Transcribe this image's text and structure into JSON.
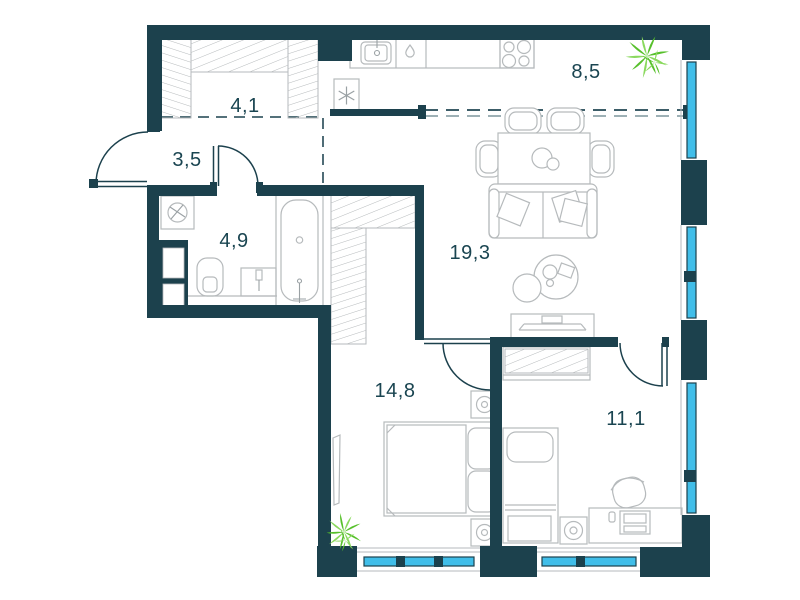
{
  "plan_title": "apartment-floor-plan",
  "rooms": [
    {
      "name": "wardrobe",
      "area": "4,1"
    },
    {
      "name": "hallway",
      "area": "3,5"
    },
    {
      "name": "bathroom",
      "area": "4,9"
    },
    {
      "name": "living-room",
      "area": "19,3"
    },
    {
      "name": "kitchen-zone",
      "area": "8,5"
    },
    {
      "name": "bedroom-1",
      "area": "14,8"
    },
    {
      "name": "bedroom-2",
      "area": "11,1"
    }
  ],
  "colors": {
    "wall": "#1c414d",
    "window_glass": "#41bee9",
    "furniture_line": "#b6babc",
    "furniture_line_dark": "#9aa1a4",
    "plant_primary": "#57c02b",
    "plant_secondary": "#8ad95e",
    "label_text": "#1a4551",
    "zone_dash": "#3c5d68",
    "zone_dash_light": "#9db0b5",
    "background": "#ffffff"
  },
  "icons": {
    "fridge_symbol": "snowflake-icon",
    "dishwasher_symbol": "droplet-icon",
    "plant_symbol": "plant-icon",
    "washing_machine_symbol": "drum-icon"
  }
}
